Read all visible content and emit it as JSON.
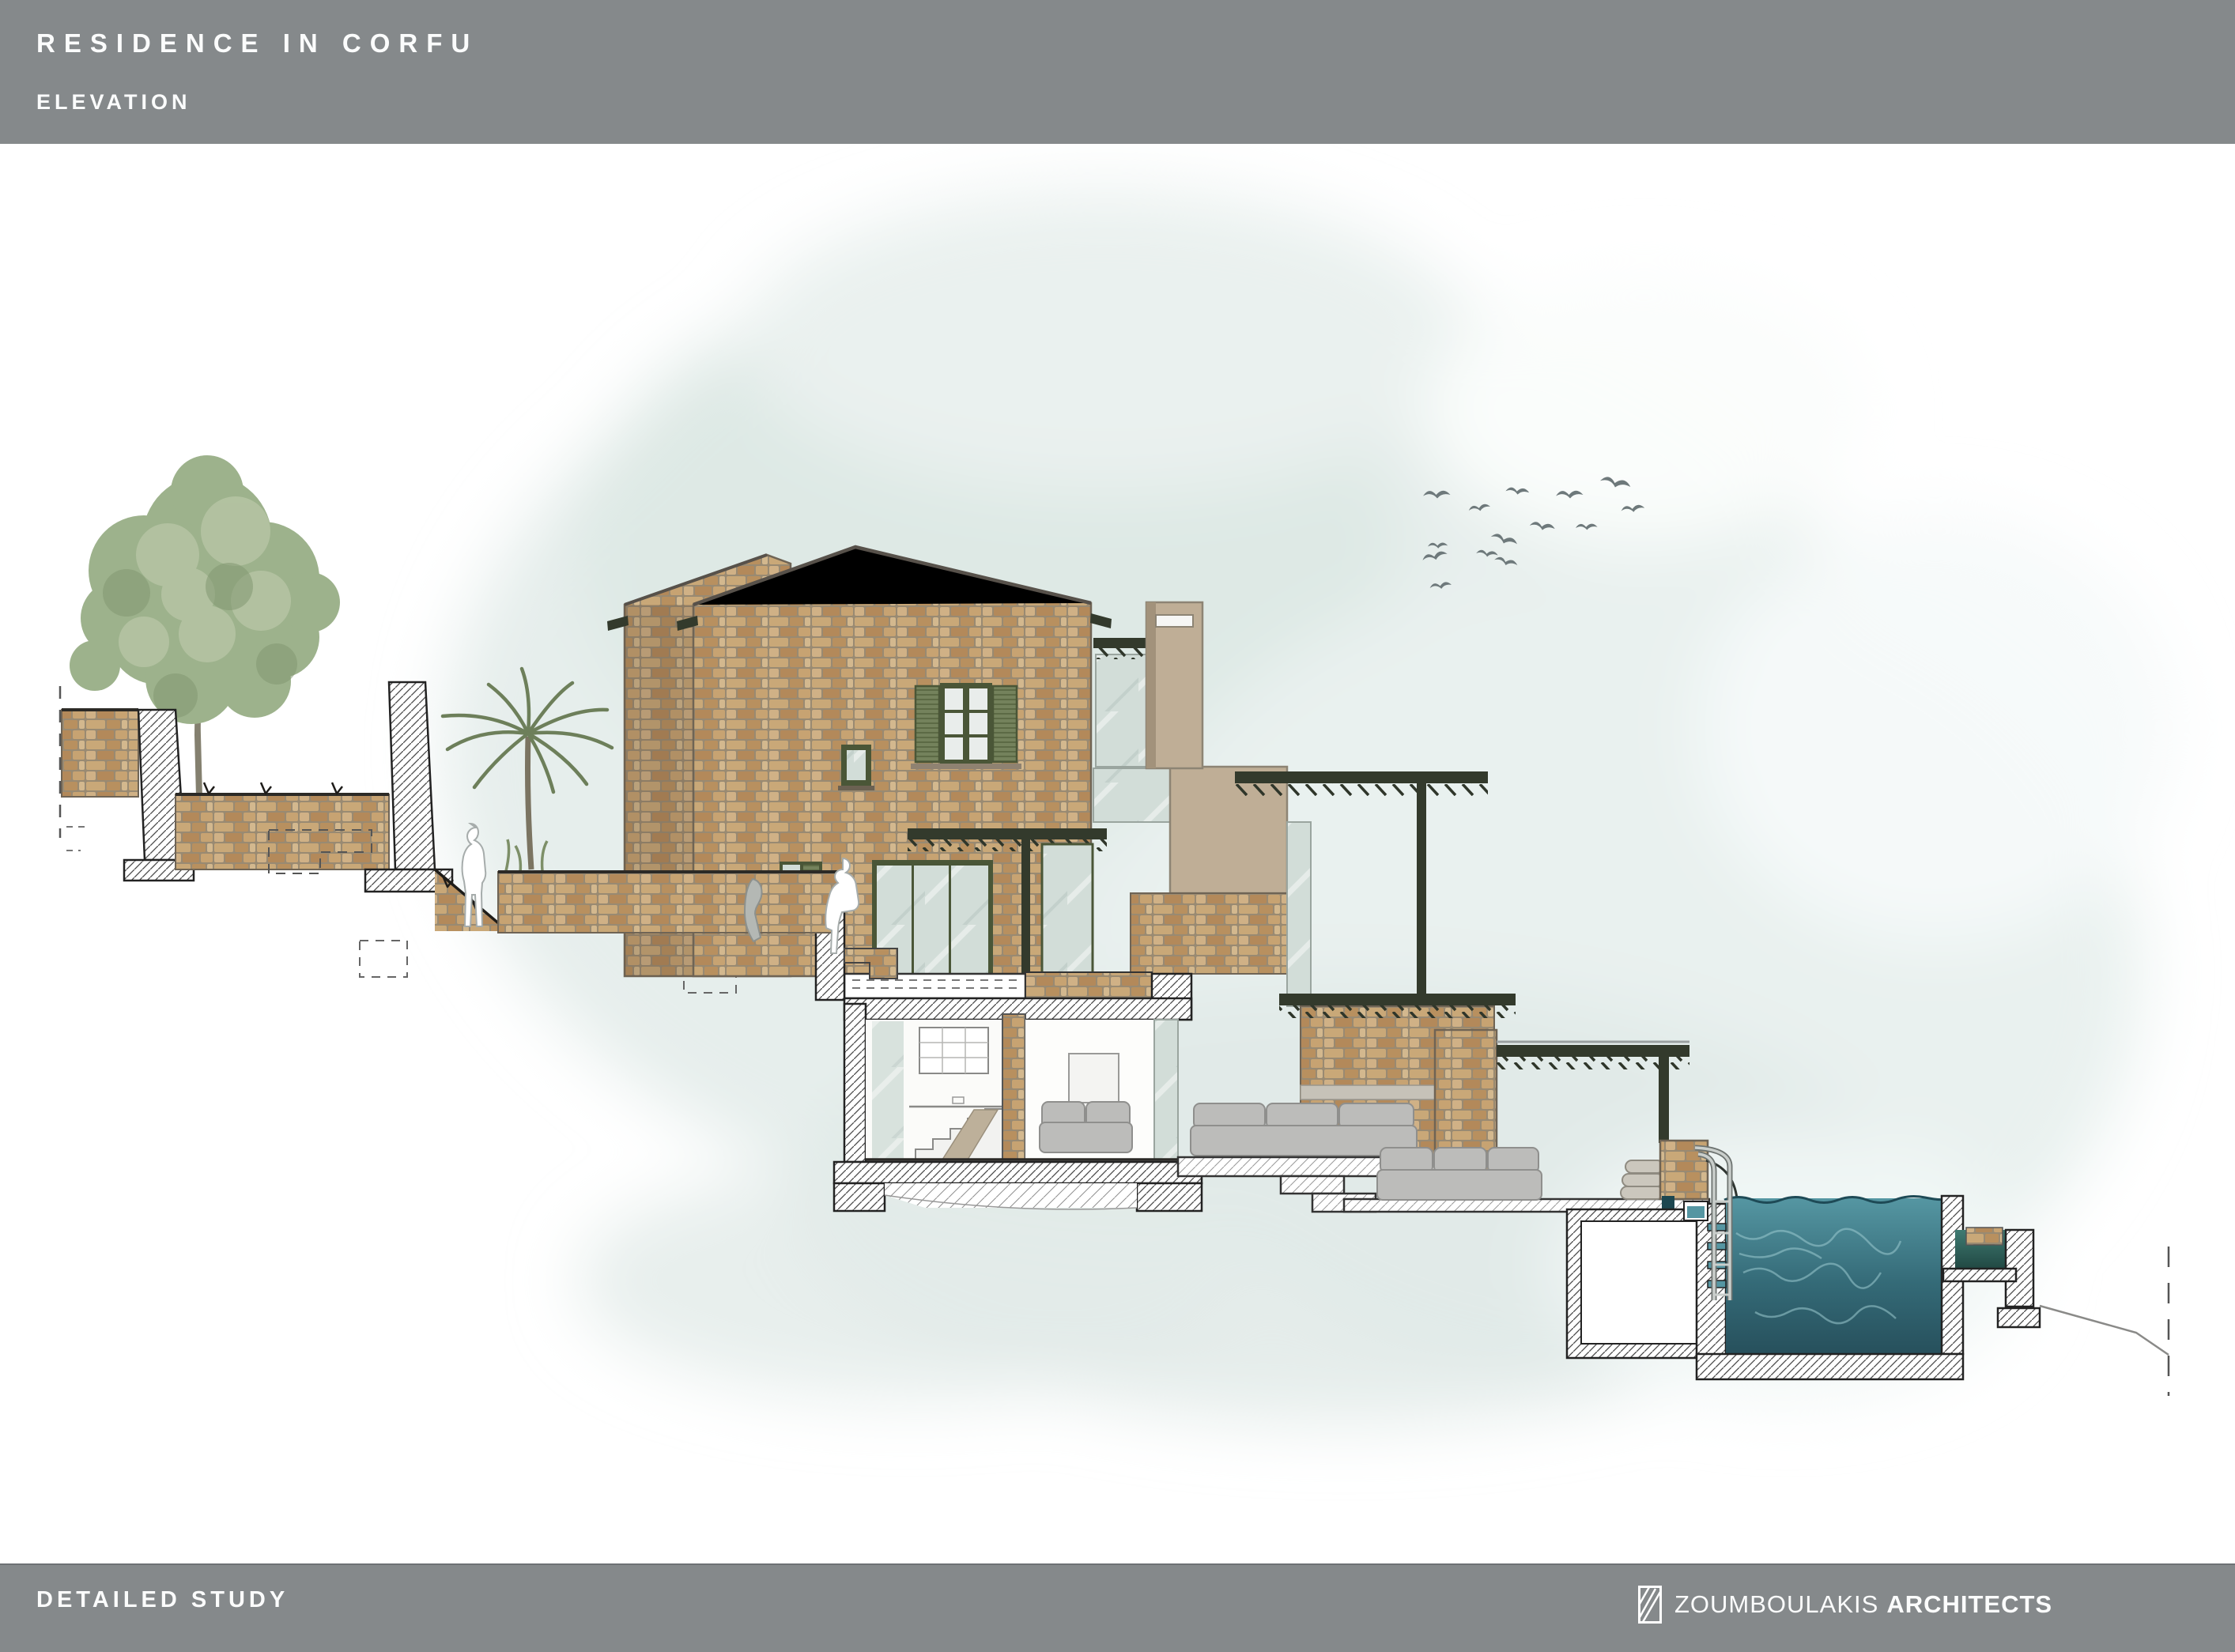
{
  "header": {
    "title": "RESIDENCE IN CORFU",
    "subtitle": "ELEVATION"
  },
  "footer": {
    "left": "DETAILED STUDY",
    "brand": {
      "name": "ZOUMBOULAKIS",
      "suffix": "ARCHITECTS"
    }
  },
  "palette": {
    "bar-gray": "#85898b",
    "bar-text": "#fbfcfc",
    "wash": "#e6eeec",
    "wash-deep": "#dce7e4",
    "mortar": "#998a72",
    "stone-edge": "#6f6455",
    "tan-concrete": "#bfae96",
    "tan-edge": "#8d8474",
    "pergola-dark": "#333a2c",
    "shutter-green": "#74825c",
    "frame-green": "#4a5637",
    "glass": "#d2ddd8",
    "pool-top": "#5596a2",
    "pool-deep": "#27505c",
    "basin-top": "#3f7b72",
    "basin-deep": "#1f4540",
    "bird-gray": "#6e797b",
    "sofa-gray": "#bcbcba",
    "sofa-edge": "#8f8f8d",
    "line-dark": "#3e3b35",
    "foliage": "#9db28c",
    "foliage-light": "#b9c7a7",
    "foliage-dark": "#83987290"
  }
}
